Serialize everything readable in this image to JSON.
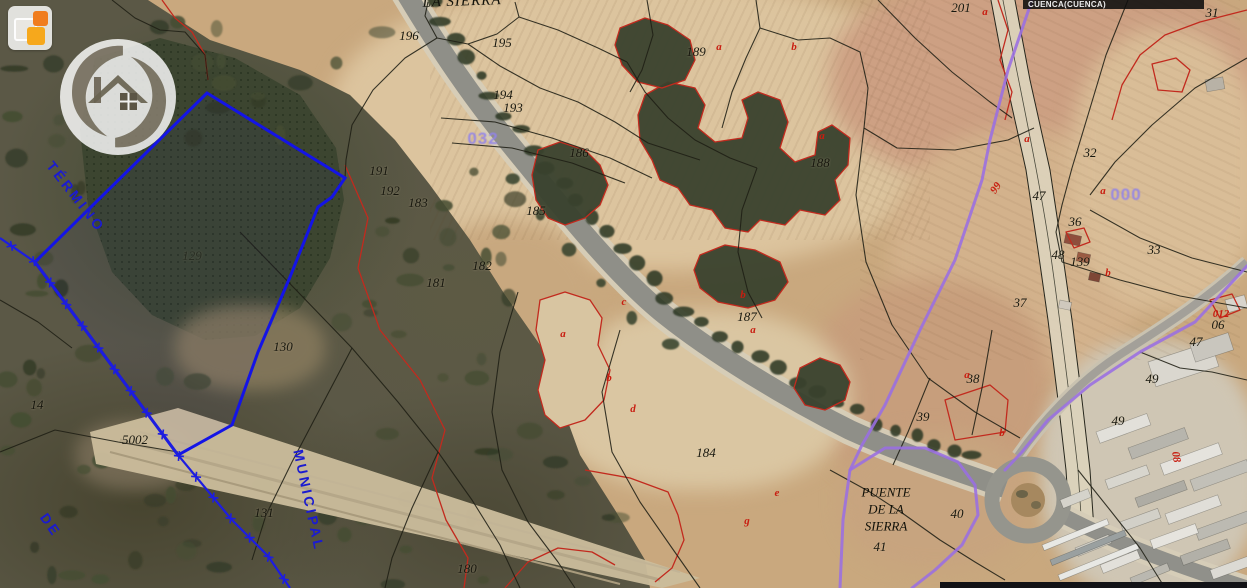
{
  "header": {
    "region_label": "CUENCA(CUENCA)"
  },
  "overlay_texts": {
    "la_sierra": "LA SIERRA",
    "termino": "TÉRMINO",
    "municipal": "MUNICIPAL",
    "de": "DE",
    "puente": [
      "PUENTE",
      "DE LA",
      "SIERRA"
    ]
  },
  "polygon_numbers": [
    {
      "text": "032",
      "x": 483,
      "y": 139
    },
    {
      "text": "000",
      "x": 1126,
      "y": 195
    }
  ],
  "parcel_numbers": [
    {
      "text": "196",
      "x": 409,
      "y": 36
    },
    {
      "text": "195",
      "x": 502,
      "y": 43
    },
    {
      "text": "194",
      "x": 503,
      "y": 95
    },
    {
      "text": "193",
      "x": 513,
      "y": 108
    },
    {
      "text": "191",
      "x": 379,
      "y": 171
    },
    {
      "text": "192",
      "x": 390,
      "y": 191
    },
    {
      "text": "183",
      "x": 418,
      "y": 203
    },
    {
      "text": "182",
      "x": 482,
      "y": 266
    },
    {
      "text": "181",
      "x": 436,
      "y": 283
    },
    {
      "text": "189",
      "x": 696,
      "y": 52
    },
    {
      "text": "201",
      "x": 961,
      "y": 8
    },
    {
      "text": "31",
      "x": 1212,
      "y": 13
    },
    {
      "text": "188",
      "x": 820,
      "y": 163
    },
    {
      "text": "186",
      "x": 579,
      "y": 153
    },
    {
      "text": "185",
      "x": 536,
      "y": 211
    },
    {
      "text": "187",
      "x": 747,
      "y": 317
    },
    {
      "text": "129",
      "x": 192,
      "y": 256,
      "faint": true
    },
    {
      "text": "130",
      "x": 283,
      "y": 347
    },
    {
      "text": "14",
      "x": 37,
      "y": 405
    },
    {
      "text": "5002",
      "x": 135,
      "y": 440
    },
    {
      "text": "131",
      "x": 264,
      "y": 513
    },
    {
      "text": "184",
      "x": 706,
      "y": 453
    },
    {
      "text": "180",
      "x": 467,
      "y": 569
    },
    {
      "text": "32",
      "x": 1090,
      "y": 153
    },
    {
      "text": "47",
      "x": 1039,
      "y": 196
    },
    {
      "text": "36",
      "x": 1075,
      "y": 222
    },
    {
      "text": "48",
      "x": 1058,
      "y": 255
    },
    {
      "text": "139",
      "x": 1080,
      "y": 262
    },
    {
      "text": "33",
      "x": 1154,
      "y": 250
    },
    {
      "text": "37",
      "x": 1020,
      "y": 303
    },
    {
      "text": "38",
      "x": 973,
      "y": 379
    },
    {
      "text": "39",
      "x": 923,
      "y": 417
    },
    {
      "text": "49",
      "x": 1118,
      "y": 421
    },
    {
      "text": "49",
      "x": 1152,
      "y": 379
    },
    {
      "text": "47",
      "x": 1196,
      "y": 342
    },
    {
      "text": "06",
      "x": 1218,
      "y": 325
    },
    {
      "text": "40",
      "x": 957,
      "y": 514
    },
    {
      "text": "41",
      "x": 880,
      "y": 547
    }
  ],
  "subparcel_letters": [
    {
      "text": "a",
      "x": 719,
      "y": 47
    },
    {
      "text": "b",
      "x": 794,
      "y": 47
    },
    {
      "text": "a",
      "x": 985,
      "y": 12
    },
    {
      "text": "a",
      "x": 822,
      "y": 136
    },
    {
      "text": "a",
      "x": 1027,
      "y": 139
    },
    {
      "text": "a",
      "x": 1103,
      "y": 191
    },
    {
      "text": "b",
      "x": 1108,
      "y": 273
    },
    {
      "text": "a",
      "x": 563,
      "y": 334
    },
    {
      "text": "b",
      "x": 609,
      "y": 378
    },
    {
      "text": "c",
      "x": 624,
      "y": 302
    },
    {
      "text": "d",
      "x": 633,
      "y": 409
    },
    {
      "text": "b",
      "x": 743,
      "y": 295
    },
    {
      "text": "a",
      "x": 753,
      "y": 330
    },
    {
      "text": "e",
      "x": 777,
      "y": 493
    },
    {
      "text": "g",
      "x": 747,
      "y": 521
    },
    {
      "text": "a",
      "x": 967,
      "y": 375
    },
    {
      "text": "b",
      "x": 1002,
      "y": 433
    },
    {
      "text": "012",
      "x": 1221,
      "y": 314
    },
    {
      "text": "99",
      "x": 996,
      "y": 188,
      "rot": -55
    },
    {
      "text": "08",
      "x": 1176,
      "y": 457,
      "rot": 80
    }
  ],
  "icons": {
    "app_logo": "tiles-logo",
    "watermark": "house-swirl-realestate-logo"
  },
  "colors": {
    "selected_parcel": "#1414e6",
    "municipal_boundary": "#1d1de0",
    "admin_boundary_purple": "#9a6ee3",
    "subparcel_red": "#c22a1e",
    "parcel_line_black": "#1f1f14",
    "polygon_number_purple": "#9183ea",
    "admin_text_blue": "#1b1bd0",
    "header_bar_bg": "#0e0e0e"
  }
}
